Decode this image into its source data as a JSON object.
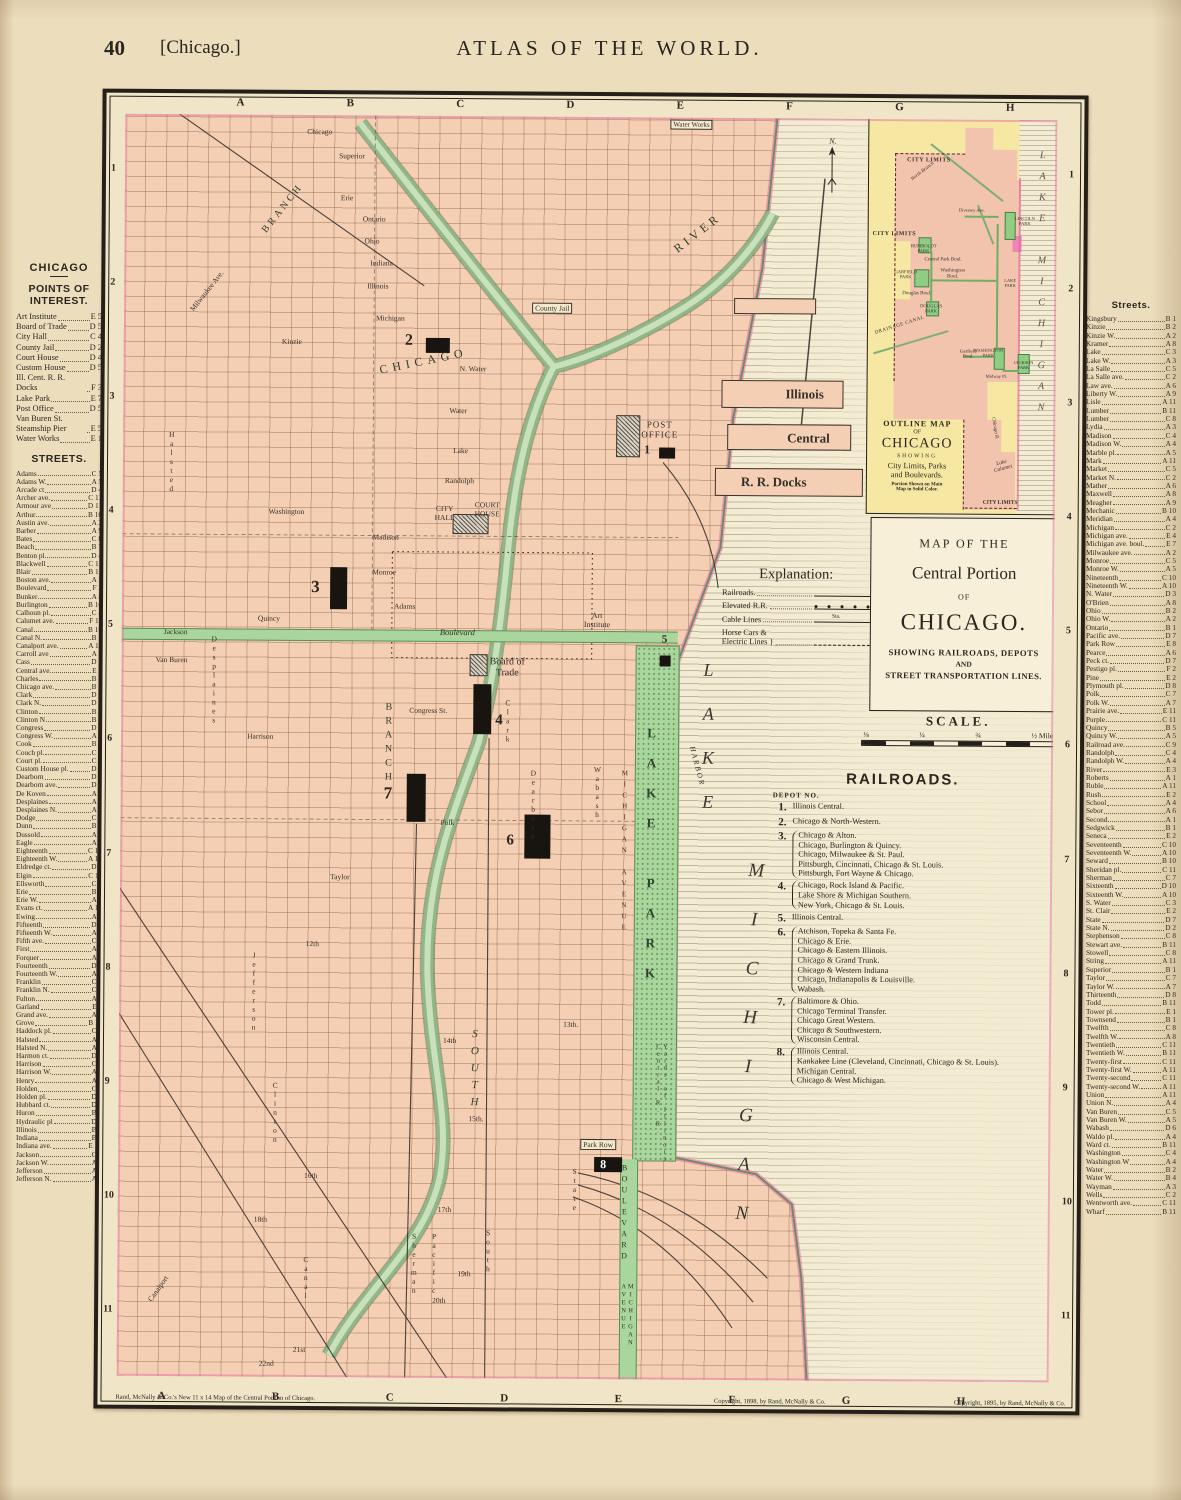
{
  "header": {
    "page_number": "40",
    "page_label": "[Chicago.]",
    "title": "ATLAS OF THE WORLD."
  },
  "left_sidebar": {
    "city_heading": "CHICAGO",
    "poi_heading": "POINTS OF INTEREST.",
    "poi": [
      {
        "n": "Art Institute",
        "r": "E 5"
      },
      {
        "n": "Board of Trade",
        "r": "D 5"
      },
      {
        "n": "City Hall",
        "r": "C 4"
      },
      {
        "n": "County Jail",
        "r": "D 2"
      },
      {
        "n": "Court House",
        "r": "D 4"
      },
      {
        "n": "Custom House",
        "r": "D 5"
      },
      {
        "n": "Ill. Cent. R. R. Docks",
        "r": "F 3"
      },
      {
        "n": "Lake Park",
        "r": "E 7"
      },
      {
        "n": "Post Office",
        "r": "D 5"
      },
      {
        "n": "Van Buren St. Steamship Pier",
        "r": "E 5"
      },
      {
        "n": "Water Works",
        "r": "E 1"
      }
    ],
    "streets_heading": "STREETS.",
    "streets": [
      {
        "n": "Adams",
        "r": "C 5"
      },
      {
        "n": "Adams W.",
        "r": "A 5"
      },
      {
        "n": "Arcade ct",
        "r": "D 4"
      },
      {
        "n": "Archer ave.",
        "r": "C 11"
      },
      {
        "n": "Armour ave",
        "r": "D 11"
      },
      {
        "n": "Arthur",
        "r": "B 10"
      },
      {
        "n": "Austin ave.",
        "r": "A 2"
      },
      {
        "n": "Barber",
        "r": "A 9"
      },
      {
        "n": "Bates",
        "r": "C 8"
      },
      {
        "n": "Beach",
        "r": "B 7"
      },
      {
        "n": "Benton pl.",
        "r": "D 4"
      },
      {
        "n": "Blackwell",
        "r": "C 11"
      },
      {
        "n": "Blair",
        "r": "B 11"
      },
      {
        "n": "Boston ave.",
        "r": "A 5"
      },
      {
        "n": "Boulevard",
        "r": "F 2"
      },
      {
        "n": "Bunker",
        "r": "A 8"
      },
      {
        "n": "Burlington",
        "r": "B 10"
      },
      {
        "n": "Calhoun pl.",
        "r": "C 4"
      },
      {
        "n": "Calumet ave.",
        "r": "F 11"
      },
      {
        "n": "Canal",
        "r": "B 10"
      },
      {
        "n": "Canal N.",
        "r": "B 3"
      },
      {
        "n": "Canalport ave.",
        "r": "A 11"
      },
      {
        "n": "Carroll ave",
        "r": "A 3"
      },
      {
        "n": "Cass",
        "r": "D 2"
      },
      {
        "n": "Central ave.",
        "r": "E 3"
      },
      {
        "n": "Charles",
        "r": "B 5"
      },
      {
        "n": "Chicago ave.",
        "r": "B 1"
      },
      {
        "n": "Clark",
        "r": "D 6"
      },
      {
        "n": "Clark N.",
        "r": "D 2"
      },
      {
        "n": "Clinton",
        "r": "B 8"
      },
      {
        "n": "Clinton N",
        "r": "B 3"
      },
      {
        "n": "Congress",
        "r": "D 6"
      },
      {
        "n": "Congress W.",
        "r": "A 6"
      },
      {
        "n": "Cook",
        "r": "B 2"
      },
      {
        "n": "Couch pl.",
        "r": "C 4"
      },
      {
        "n": "Court pl.",
        "r": "C 4"
      },
      {
        "n": "Custom House pl.",
        "r": "D 8"
      },
      {
        "n": "Dearborn",
        "r": "D 6"
      },
      {
        "n": "Dearborn ave.",
        "r": "D 2"
      },
      {
        "n": "De Koven",
        "r": "A 7"
      },
      {
        "n": "Desplaines",
        "r": "A 7"
      },
      {
        "n": "Desplaines N.",
        "r": "A 2"
      },
      {
        "n": "Dodge",
        "r": "C 8"
      },
      {
        "n": "Dunn",
        "r": "B 2"
      },
      {
        "n": "Dussold",
        "r": "A 8"
      },
      {
        "n": "Eagle",
        "r": "A 4"
      },
      {
        "n": "Eighteenth",
        "r": "C 10"
      },
      {
        "n": "Eighteenth W.",
        "r": "A 10"
      },
      {
        "n": "Eldredge ct.",
        "r": "D 7"
      },
      {
        "n": "Elgin",
        "r": "C 11"
      },
      {
        "n": "Ellsworth",
        "r": "C 6"
      },
      {
        "n": "Erie",
        "r": "B 1"
      },
      {
        "n": "Erie W.",
        "r": "A 1"
      },
      {
        "n": "Evans ct.",
        "r": "A 10"
      },
      {
        "n": "Ewing",
        "r": "A 7"
      },
      {
        "n": "Fifteenth",
        "r": "D 9"
      },
      {
        "n": "Fifteenth W.",
        "r": "A 9"
      },
      {
        "n": "Fifth ave.",
        "r": "C 7"
      },
      {
        "n": "First",
        "r": "A 1"
      },
      {
        "n": "Forquer",
        "r": "A 7"
      },
      {
        "n": "Fourteenth",
        "r": "D 9"
      },
      {
        "n": "Fourteenth W.",
        "r": "A 9"
      },
      {
        "n": "Franklin",
        "r": "C 6"
      },
      {
        "n": "Franklin N.",
        "r": "C 2"
      },
      {
        "n": "Fulton",
        "r": "A 3"
      },
      {
        "n": "Garland",
        "r": "E 4"
      },
      {
        "n": "Grand ave.",
        "r": "A 2"
      },
      {
        "n": "Grove",
        "r": "B 11"
      },
      {
        "n": "Haddock pl.",
        "r": "C 3"
      },
      {
        "n": "Halsted",
        "r": "A 8"
      },
      {
        "n": "Halsted N.",
        "r": "A 2"
      },
      {
        "n": "Harmon ct.",
        "r": "D 7"
      },
      {
        "n": "Harrison",
        "r": "C 6"
      },
      {
        "n": "Harrison W.",
        "r": "A 6"
      },
      {
        "n": "Henry",
        "r": "A 9"
      },
      {
        "n": "Holden",
        "r": "C 8"
      },
      {
        "n": "Holden pl.",
        "r": "D 4"
      },
      {
        "n": "Hubbard ct.",
        "r": "D 6"
      },
      {
        "n": "Huron",
        "r": "B 1"
      },
      {
        "n": "Hydraulic pl",
        "r": "D 5"
      },
      {
        "n": "Illinois",
        "r": "B 2"
      },
      {
        "n": "Indiana",
        "r": "B 2"
      },
      {
        "n": "Indiana ave.",
        "r": "E 10"
      },
      {
        "n": "Jackson",
        "r": "C 5"
      },
      {
        "n": "Jackson W.",
        "r": "A 5"
      },
      {
        "n": "Jefferson",
        "r": "A 7"
      },
      {
        "n": "Jefferson N.",
        "r": "A 3"
      }
    ]
  },
  "right_sidebar": {
    "heading": "Streets.",
    "streets": [
      {
        "n": "Kingsbury",
        "r": "B 1"
      },
      {
        "n": "Kinzie",
        "r": "B 2"
      },
      {
        "n": "Kinzie W.",
        "r": "A 2"
      },
      {
        "n": "Kramer",
        "r": "A 8"
      },
      {
        "n": "Lake",
        "r": "C 3"
      },
      {
        "n": "Lake W.",
        "r": "A 3"
      },
      {
        "n": "La Salle",
        "r": "C 5"
      },
      {
        "n": "La Salle ave.",
        "r": "C 2"
      },
      {
        "n": "Law ave.",
        "r": "A 6"
      },
      {
        "n": "Liberty W.",
        "r": "A 9"
      },
      {
        "n": "Lisle",
        "r": "A 11"
      },
      {
        "n": "Lumber",
        "r": "B 11"
      },
      {
        "n": "Lumber",
        "r": "C 8"
      },
      {
        "n": "Lydia",
        "r": "A 3"
      },
      {
        "n": "Madison",
        "r": "C 4"
      },
      {
        "n": "Madison W.",
        "r": "A 4"
      },
      {
        "n": "Marble pl.",
        "r": "A 5"
      },
      {
        "n": "Mark",
        "r": "A 11"
      },
      {
        "n": "Market",
        "r": "C 5"
      },
      {
        "n": "Market N.",
        "r": "C 2"
      },
      {
        "n": "Mather",
        "r": "A 6"
      },
      {
        "n": "Maxwell",
        "r": "A 8"
      },
      {
        "n": "Meagher",
        "r": "A 9"
      },
      {
        "n": "Mechanic",
        "r": "B 10"
      },
      {
        "n": "Meridian",
        "r": "A 4"
      },
      {
        "n": "Michigan",
        "r": "C 2"
      },
      {
        "n": "Michigan ave.",
        "r": "E 4"
      },
      {
        "n": "Michigan ave. boul.",
        "r": "E 7"
      },
      {
        "n": "Milwaukee ave.",
        "r": "A 2"
      },
      {
        "n": "Monroe",
        "r": "C 5"
      },
      {
        "n": "Monroe W.",
        "r": "A 5"
      },
      {
        "n": "Nineteenth",
        "r": "C 10"
      },
      {
        "n": "Nineteenth W.",
        "r": "A 10"
      },
      {
        "n": "N. Water",
        "r": "D 3"
      },
      {
        "n": "O'Brien",
        "r": "A 8"
      },
      {
        "n": "Ohio",
        "r": "B 2"
      },
      {
        "n": "Ohio W.",
        "r": "A 2"
      },
      {
        "n": "Ontario",
        "r": "B 1"
      },
      {
        "n": "Pacific ave.",
        "r": "D 7"
      },
      {
        "n": "Park Row",
        "r": "E 8"
      },
      {
        "n": "Pearce",
        "r": "A 6"
      },
      {
        "n": "Peck ct.",
        "r": "D 7"
      },
      {
        "n": "Pestigo pl.",
        "r": "F 2"
      },
      {
        "n": "Pine",
        "r": "E 2"
      },
      {
        "n": "Plymouth pl.",
        "r": "D 8"
      },
      {
        "n": "Polk",
        "r": "C 7"
      },
      {
        "n": "Polk W.",
        "r": "A 7"
      },
      {
        "n": "Prairie ave.",
        "r": "E 11"
      },
      {
        "n": "Purple",
        "r": "C 11"
      },
      {
        "n": "Quincy",
        "r": "B 5"
      },
      {
        "n": "Quincy W.",
        "r": "A 5"
      },
      {
        "n": "Railroad ave.",
        "r": "C 9"
      },
      {
        "n": "Randolph",
        "r": "C 4"
      },
      {
        "n": "Randolph W.",
        "r": "A 4"
      },
      {
        "n": "River",
        "r": "E 3"
      },
      {
        "n": "Roberts",
        "r": "A 1"
      },
      {
        "n": "Ruble",
        "r": "A 11"
      },
      {
        "n": "Rush",
        "r": "E 2"
      },
      {
        "n": "School",
        "r": "A 4"
      },
      {
        "n": "Sebor",
        "r": "A 6"
      },
      {
        "n": "Second",
        "r": "A 1"
      },
      {
        "n": "Sedgwick",
        "r": "B 1"
      },
      {
        "n": "Seneca",
        "r": "E 2"
      },
      {
        "n": "Seventeenth",
        "r": "C 10"
      },
      {
        "n": "Seventeenth W.",
        "r": "A 10"
      },
      {
        "n": "Seward",
        "r": "B 10"
      },
      {
        "n": "Sheridan pl.",
        "r": "C 11"
      },
      {
        "n": "Sherman",
        "r": "C 7"
      },
      {
        "n": "Sixteenth",
        "r": "D 10"
      },
      {
        "n": "Sixteenth W.",
        "r": "A 10"
      },
      {
        "n": "S. Water",
        "r": "C 3"
      },
      {
        "n": "St. Clair",
        "r": "E 2"
      },
      {
        "n": "State",
        "r": "D 7"
      },
      {
        "n": "State N.",
        "r": "D 2"
      },
      {
        "n": "Stephenson",
        "r": "C 8"
      },
      {
        "n": "Stewart ave.",
        "r": "B 11"
      },
      {
        "n": "Stowell",
        "r": "C 8"
      },
      {
        "n": "String",
        "r": "A 11"
      },
      {
        "n": "Superior",
        "r": "B 1"
      },
      {
        "n": "Taylor",
        "r": "C 7"
      },
      {
        "n": "Taylor W.",
        "r": "A 7"
      },
      {
        "n": "Thirteenth",
        "r": "D 8"
      },
      {
        "n": "Todd",
        "r": "B 11"
      },
      {
        "n": "Tower pl.",
        "r": "E 1"
      },
      {
        "n": "Townsend",
        "r": "B 1"
      },
      {
        "n": "Twelfth",
        "r": "C 8"
      },
      {
        "n": "Twelfth W.",
        "r": "A 8"
      },
      {
        "n": "Twentieth",
        "r": "C 11"
      },
      {
        "n": "Twentieth W.",
        "r": "B 11"
      },
      {
        "n": "Twenty-first",
        "r": "C 11"
      },
      {
        "n": "Twenty-first W.",
        "r": "A 11"
      },
      {
        "n": "Twenty-second",
        "r": "C 11"
      },
      {
        "n": "Twenty-second W.",
        "r": "A 11"
      },
      {
        "n": "Union",
        "r": "A 11"
      },
      {
        "n": "Union N.",
        "r": "A 4"
      },
      {
        "n": "Van Buren",
        "r": "C 5"
      },
      {
        "n": "Van Buren W.",
        "r": "A 5"
      },
      {
        "n": "Wabash",
        "r": "D 6"
      },
      {
        "n": "Waldo pl.",
        "r": "A 4"
      },
      {
        "n": "Ward ct.",
        "r": "B 11"
      },
      {
        "n": "Washington",
        "r": "C 4"
      },
      {
        "n": "Washington W",
        "r": "A 4"
      },
      {
        "n": "Water",
        "r": "B 2"
      },
      {
        "n": "Water W.",
        "r": "B 4"
      },
      {
        "n": "Wayman",
        "r": "A 3"
      },
      {
        "n": "Wells",
        "r": "C 2"
      },
      {
        "n": "Wentworth ave.",
        "r": "C 11"
      },
      {
        "n": "Wharf",
        "r": "B 11"
      }
    ]
  },
  "map": {
    "grid_letters": [
      "A",
      "B",
      "C",
      "D",
      "E",
      "F",
      "G",
      "H"
    ],
    "grid_numbers": [
      "1",
      "2",
      "3",
      "4",
      "5",
      "6",
      "7",
      "8",
      "9",
      "10",
      "11"
    ],
    "compass": "N.",
    "depots": [
      "1",
      "2",
      "3",
      "4",
      "5",
      "6",
      "7",
      "8"
    ],
    "labels": {
      "water_works": "Water Works",
      "county_jail": "County Jail",
      "chicago_river_1": "CHICAGO",
      "chicago_river_2": "RIVER",
      "branch_n": "BRANCH",
      "branch_s": "BRANCH",
      "south_big": "SOUTH",
      "pier_illinois": "Illinois",
      "pier_central": "Central",
      "pier_docks": "R. R. Docks",
      "post_office": "POST\nOFFICE",
      "court_house": "COURT\nHOUSE",
      "city_hall": "CITY\nHALL",
      "board_of_trade": "Board of\nTrade",
      "art_institute": "Art\nInstitute",
      "lake_park": "LAKE PARK",
      "michigan_avenue": "MICHIGAN AVENUE",
      "boulevard": "BOULEVARD",
      "michigan_avenue_2": "MICHIGAN AVENUE",
      "park_row": "Park Row",
      "lake_big": "LAKE",
      "michigan_big": "MICHIGAN",
      "harbor": "HARBOR",
      "yards": "Yards of Illinois Central R. R.",
      "jackson_band": "Jackson",
      "boulevard_band": "Boulevard"
    },
    "streets": {
      "chicago": "Chicago",
      "superior": "Superior",
      "erie": "Erie",
      "ontario": "Ontario",
      "ohio": "Ohio",
      "indiana": "Indiana",
      "illinois": "Illinois",
      "michigan": "Michigan",
      "kinzie": "Kinzie",
      "n_water": "N. Water",
      "water": "Water",
      "lake": "Lake",
      "randolph": "Randolph",
      "washington": "Washington",
      "madison": "Madison",
      "monroe": "Monroe",
      "adams": "Adams",
      "quincy": "Quincy",
      "van_buren": "Van Buren",
      "congress": "Congress St.",
      "harrison": "Harrison",
      "polk": "Polk",
      "taylor": "Taylor",
      "twelfth": "12th",
      "thirteenth": "13th.",
      "fourteenth": "14th",
      "fifteenth": "15th.",
      "sixteenth": "16th",
      "seventeenth": "17th",
      "eighteenth": "18th",
      "nineteenth": "19th",
      "twentieth": "20th",
      "twenty_first": "21st",
      "twenty_second": "22nd",
      "halsted": "Halsted",
      "desplaines": "Desplaines",
      "jefferson": "Jefferson",
      "clinton": "Clinton",
      "canal": "Canal",
      "clark": "Clark",
      "dearborn": "Dearborn",
      "state": "State",
      "wabash": "Wabash",
      "sherman": "Sherman",
      "pacific": "Pacific",
      "south": "South",
      "canalport": "Canalport",
      "milwaukee": "Milwaukee Ave."
    }
  },
  "inset": {
    "labels": {
      "city_limits_top": "CITY LIMITS",
      "city_limits_mid": "CITY LIMITS",
      "city_limits_bottom": "CITY LIMITS",
      "lincoln_park": "LINCOLN\nPARK",
      "humboldt_park": "HUMBOLDT\nPARK",
      "garfield_park": "GARFIELD\nPARK",
      "douglas_park": "DOUGLAS\nPARK",
      "washington_park": "WASHINGTON\nPARK",
      "jackson_park": "JACKSON\nPARK",
      "lake_park": "LAKE\nPARK",
      "midway": "Midway Pl.",
      "diversey": "Diversey Ave.",
      "central_park_boul": "Central Park Boul.",
      "washington_boul": "Washington\nBoul.",
      "douglas_boul": "Douglas Boul.",
      "garfield_boul": "Garfield\nBoul.",
      "north_branch": "North Branch",
      "drainage_canal": "DRAINAGE CANAL",
      "chicago_r": "Chicago R.",
      "lake_calumet": "Lake\nCalumet",
      "lake_michigan": "LAKE MICHIGAN"
    },
    "caption": {
      "l1": "OUTLINE MAP",
      "l2": "OF",
      "l3": "CHICAGO",
      "l4": "SHOWING",
      "l5": "City Limits, Parks",
      "l6": "and Boulevards.",
      "l7": "Portion Shown on Main\nMap in Solid Color."
    }
  },
  "title_box": {
    "l1": "MAP OF THE",
    "l2": "Central Portion",
    "l3": "OF",
    "l4": "CHICAGO.",
    "l5": "SHOWING RAILROADS, DEPOTS",
    "l6": "AND",
    "l7": "STREET TRANSPORTATION LINES."
  },
  "scale": {
    "heading": "SCALE.",
    "t1": "⅛",
    "t2": "¼",
    "t3": "¾",
    "t4": "½ Mile"
  },
  "explanation": {
    "heading": "Explanation:",
    "sta": "Sta.",
    "rows": [
      {
        "label": "Railroads."
      },
      {
        "label": "Elevated R.R."
      },
      {
        "label": "Cable Lines"
      },
      {
        "label": "Horse Cars &\nElectric Lines }"
      }
    ]
  },
  "railroads": {
    "heading": "RAILROADS.",
    "depot_no": "DEPOT NO.",
    "entries": [
      {
        "num": "1.",
        "lines": [
          "Illinois Central."
        ]
      },
      {
        "num": "2.",
        "lines": [
          "Chicago & North-Western."
        ]
      },
      {
        "num": "3.",
        "lines": [
          "Chicago & Alton.",
          "Chicago, Burlington & Quincy.",
          "Chicago, Milwaukee & St. Paul.",
          "Pittsburgh, Cincinnati, Chicago & St. Louis.",
          "Pittsburgh, Fort Wayne & Chicago."
        ]
      },
      {
        "num": "4.",
        "lines": [
          "Chicago, Rock Island & Pacific.",
          "Lake Shore & Michigan Southern.",
          "New York, Chicago & St. Louis."
        ]
      },
      {
        "num": "5.",
        "lines": [
          "Illinois Central."
        ]
      },
      {
        "num": "6.",
        "lines": [
          "Atchison, Topeka & Santa Fe.",
          "Chicago & Erie.",
          "Chicago & Eastern Illinois.",
          "Chicago & Grand Trunk.",
          "Chicago & Western Indiana",
          "Chicago, Indianapolis & Louisville.",
          "Wabash."
        ]
      },
      {
        "num": "7.",
        "lines": [
          "Baltimore & Ohio.",
          "Chicago Terminal Transfer.",
          "Chicago Great Western.",
          "Chicago & Southwestern.",
          "Wisconsin Central."
        ]
      },
      {
        "num": "8.",
        "lines": [
          "Illinois Central.",
          "Kankakee Line (Cleveland, Cincinnati, Chicago & St. Louis).",
          "Michigan Central.",
          "Chicago & West Michigan."
        ]
      }
    ]
  },
  "footer": {
    "credit_left": "Rand, McNally & Co.'s New 11 x 14 Map of the Central Portion of Chicago.",
    "copyright_mid": "Copyright, 1898, by Rand, McNally & Co.",
    "copyright_right": "Copyright, 1895, by Rand, McNally & Co."
  }
}
